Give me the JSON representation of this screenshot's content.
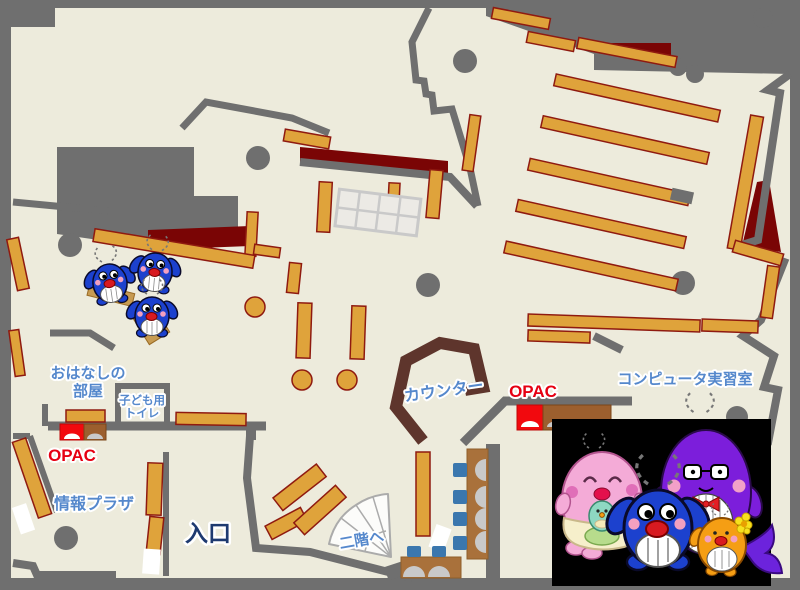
{
  "map": {
    "title": "library-first-floor-map",
    "labels": {
      "ohanashi_line1": "おはなしの",
      "ohanashi_line2": "部屋",
      "toilet_line1": "子ども用",
      "toilet_line2": "トイレ",
      "opac_left": "OPAC",
      "opac_right": "OPAC",
      "joho_plaza": "情報プラザ",
      "entrance": "入口",
      "counter": "カウンター",
      "computer_room": "コンピュータ実習室",
      "to_second_floor": "二階へ"
    },
    "colors": {
      "floor": "#edebdc",
      "wall": "#6f6f6f",
      "shelf": "#dfa33b",
      "shelf_border": "#8f1a10",
      "accent_dark_red": "#7a0505",
      "counter": "#5e352c",
      "table": "#a9713b",
      "chair": "#3b77ae",
      "seat": "#c9c9c9",
      "label_blue": "#5588cc",
      "label_red": "#e60012",
      "entrance_navy": "#1e3a70",
      "opac_red": "#f2090e",
      "opac_brown": "#9c5f2e",
      "mascot_panel": "#000000"
    },
    "mascots": {
      "panel_characters": [
        "pink-mother-whale",
        "purple-father-whale",
        "blue-child-whale",
        "orange-child-whale"
      ],
      "reading_corner": "three-blue-whale-dolls"
    }
  }
}
